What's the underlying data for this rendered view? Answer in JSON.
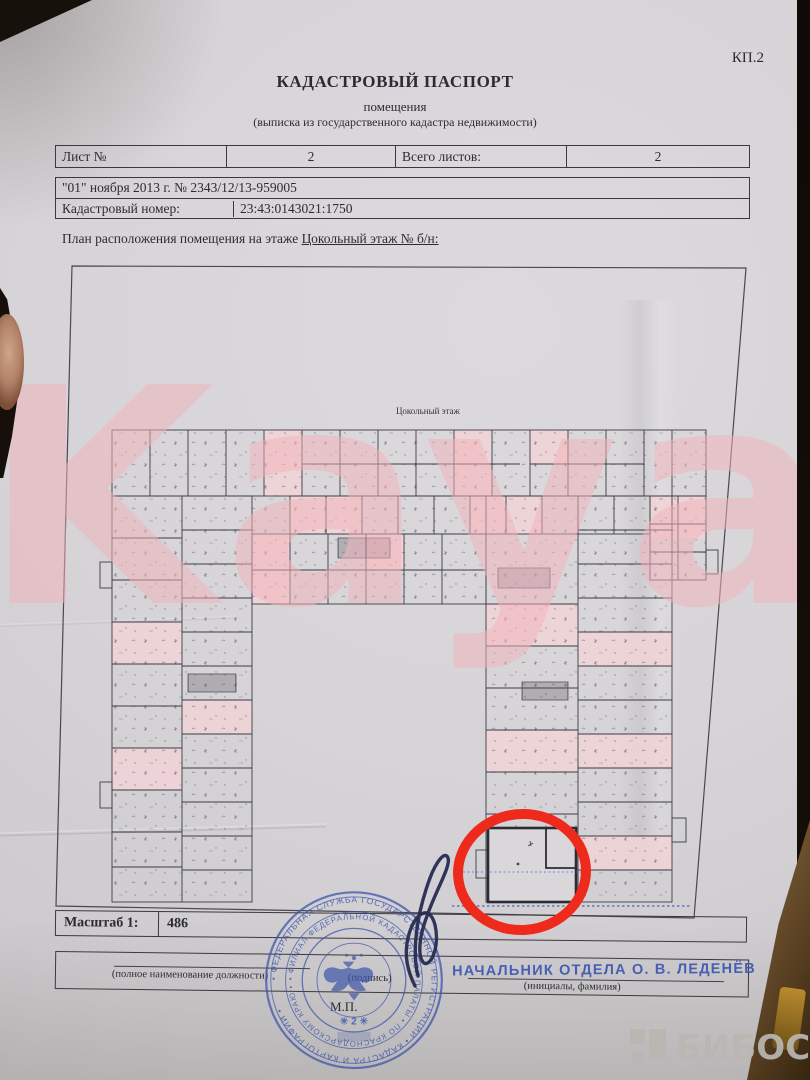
{
  "page_code": "КП.2",
  "header": {
    "title": "КАДАСТРОВЫЙ ПАСПОРТ",
    "subtitle": "помещения",
    "note": "(выписка из государственного кадастра недвижимости)"
  },
  "sheet_row": {
    "label": "Лист №",
    "value": "2",
    "total_label": "Всего листов:",
    "total_value": "2"
  },
  "doc_info": {
    "date_number": "\"01\" ноября 2013 г. № 2343/12/13-959005",
    "cadastral_label": "Кадастровый номер:",
    "cadastral_value": "23:43:0143021:1750"
  },
  "plan": {
    "intro": "План расположения помещения на этаже ",
    "floor_ref": "Цокольный этаж № б/н:",
    "caption": "Цокольный этаж",
    "scale_label": "Масштаб 1:",
    "scale_value": "486"
  },
  "footer": {
    "position_label": "(полное наименование должности)",
    "signature_label": "(подпись)",
    "initials_label": "(инициалы, фамилия)",
    "approver": "НАЧАЛЬНИК ОТДЕЛА О. В. ЛЕДЕНЁВ",
    "seal_mark": "М.П."
  },
  "stamp": {
    "ring_outer": "• ФЕДЕРАЛЬНАЯ СЛУЖБА ГОСУДАРСТВЕННОЙ РЕГИСТРАЦИИ • КАДАСТРА И КАРТОГРАФИИ •",
    "ring_middle": "• ФИЛИАЛ ФЕДЕРАЛЬНОЙ КАДАСТРОВОЙ ПАЛАТЫ • ПО КРАСНОДАРСКОМУ КРАЮ •",
    "number": "✳ 2 ✳"
  },
  "watermarks": {
    "brand": "Kayan",
    "portal": "БИБОСС"
  },
  "colors": {
    "stamp_blue": "#3c55ab",
    "annotation_red": "#ee2a1c",
    "watermark_pink": "#f2b4bc",
    "room_pink": "#f1d4d7",
    "paper": "#d6d4d7"
  }
}
